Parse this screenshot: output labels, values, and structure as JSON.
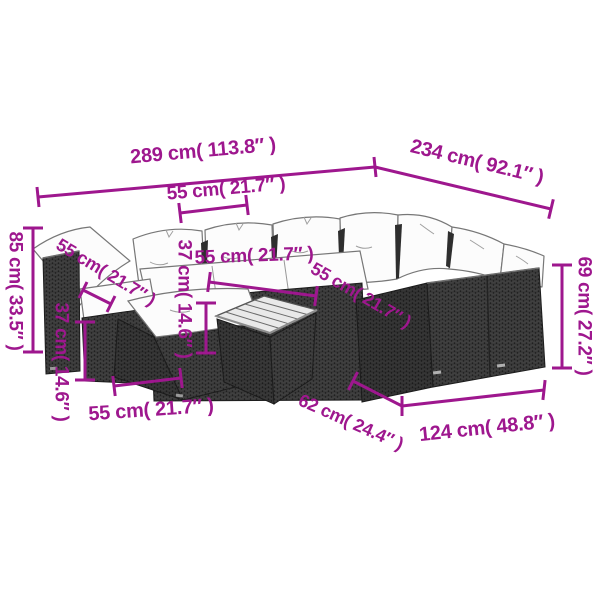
{
  "page": {
    "background_color": "#ffffff",
    "description": "Product dimension diagram of a black poly rattan garden lounge sofa set with white cushions, footstool and coffee table"
  },
  "diagram": {
    "accent_color": "#9E178E",
    "wicker_color": "#3a3a3a",
    "cushion_color": "#fcfcfc",
    "labels": {
      "total_width": "289 cm( 113.8″ )",
      "total_depth": "234 cm( 92.1″ )",
      "seat_width_top": "55 cm( 21.7″ )",
      "total_height": "85 cm( 33.5″ )",
      "seat_depth_left": "55 cm( 21.7″ )",
      "seat_height_left": "37 cm( 14.6″ )",
      "seat_width_mid": "55 cm( 21.7″ )",
      "table_height_mid": "37 cm( 14.6″ )",
      "seat_width_right": "55 cm( 21.7″ )",
      "back_height_right": "69 cm( 27.2″ )",
      "stool_width_bottom": "55 cm( 21.7″ )",
      "table_width_bottom": "62 cm( 24.4″ )",
      "sofa_length_right": "124 cm( 48.8″ )"
    }
  }
}
